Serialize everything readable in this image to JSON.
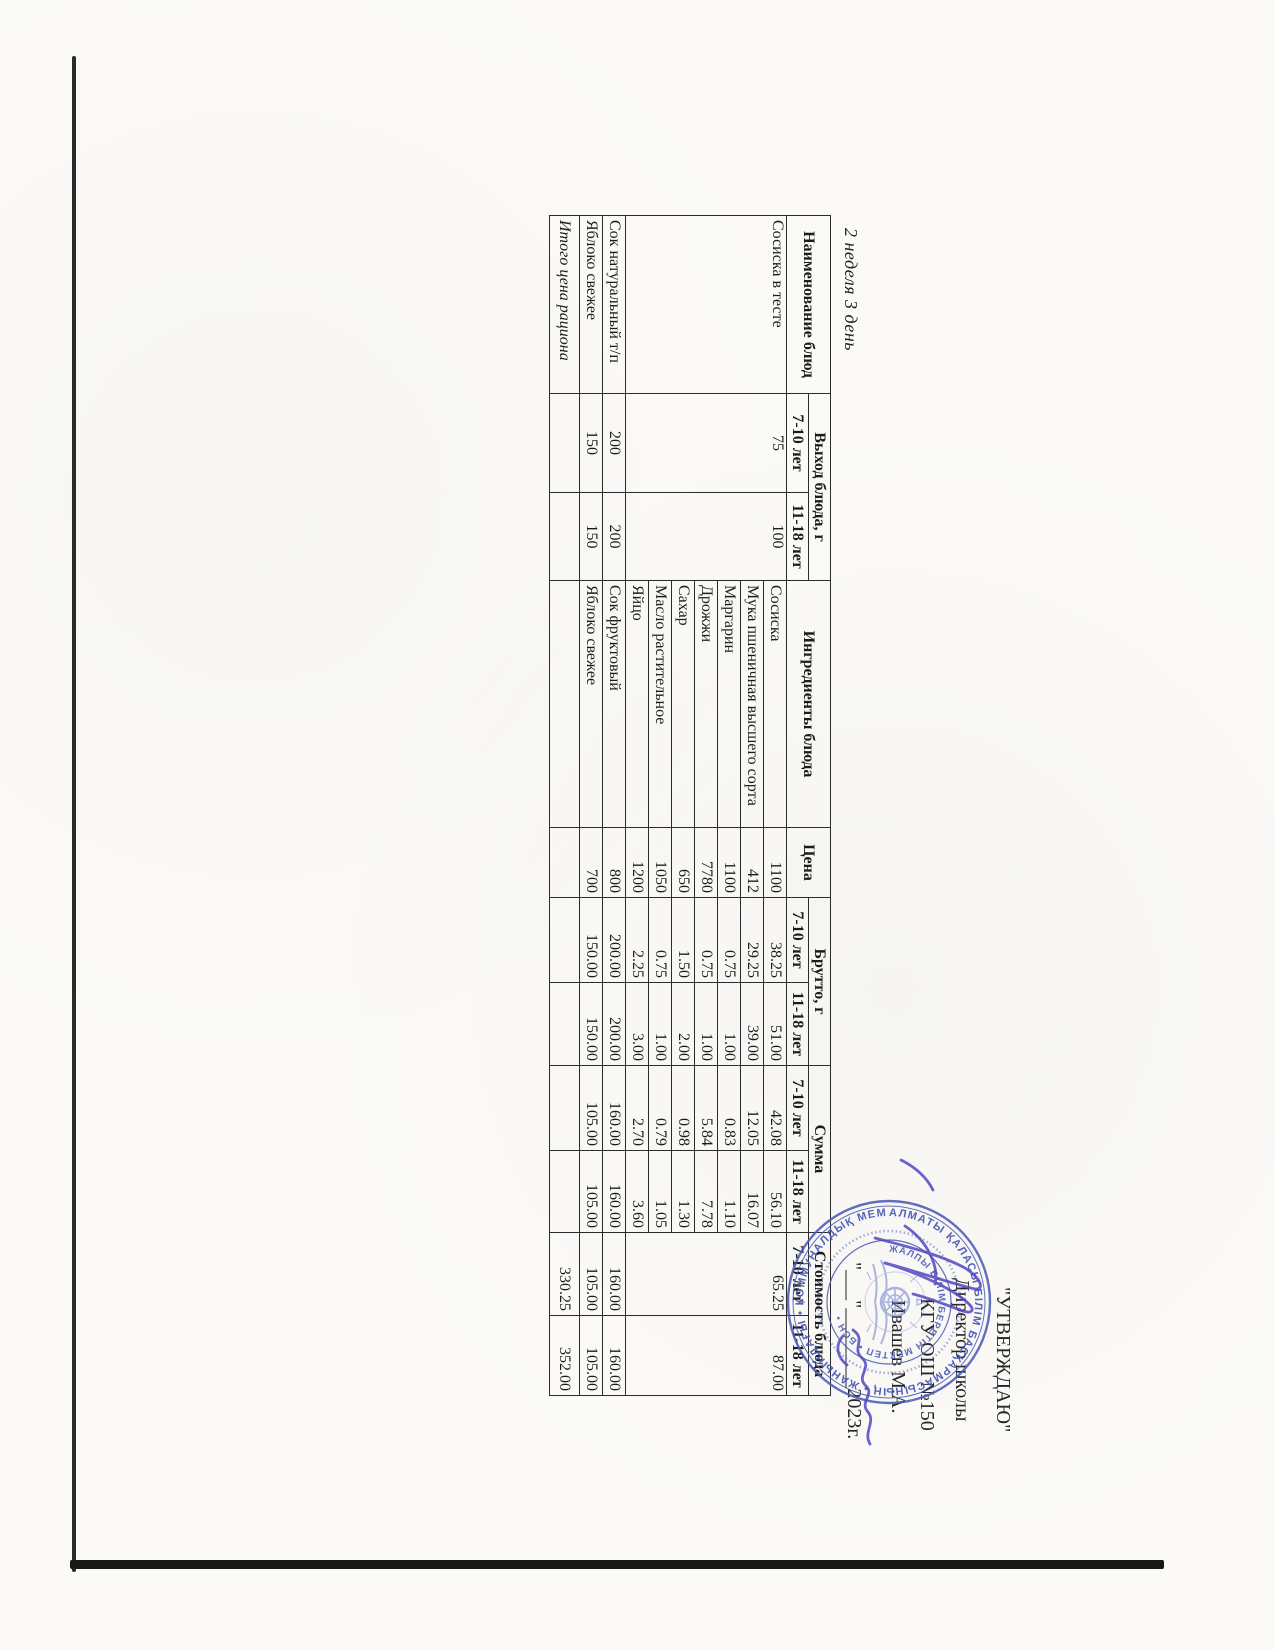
{
  "page": {
    "title": "2 неделя 3 день"
  },
  "approval": {
    "line1": "\"УТВЕРЖДАЮ\"",
    "line2": "Директор школы",
    "line3": "КГУ ОШ №150",
    "line4": "Ивашев М.А.",
    "line5": "\"___\"________2023г."
  },
  "stamp": {
    "ring_outer": "АЛМАТЫ ҚАЛАСЫ БІЛІМ БАСҚАРМАСЫНЫҢ • ЖАНЫНДАҒЫ • КОММУНАЛДЫҚ МЕМЛЕКЕТТІК МЕКЕМЕСІ",
    "ring_inner": "ЖАЛПЫ БІЛІМ БЕРЕТІН МЕКТЕП • БСН •",
    "star": "*",
    "ink_color": "#4656b6"
  },
  "table": {
    "col_widths": [
      178,
      99,
      88,
      247,
      70,
      85,
      83,
      85,
      82,
      83,
      80
    ],
    "header_row1": [
      {
        "t": "Наименование блюд",
        "rs": 2
      },
      {
        "t": "Выход блюда, г",
        "cs": 2
      },
      {
        "t": "Ингредиенты блюда",
        "rs": 2
      },
      {
        "t": "Цена",
        "rs": 2
      },
      {
        "t": "Брутто, г",
        "cs": 2
      },
      {
        "t": "Сумма",
        "cs": 2
      },
      {
        "t": "Стоимость блюда",
        "cs": 2
      }
    ],
    "header_row2": [
      "7-10 лет",
      "11-18 лет",
      "7-10 лет",
      "11-18 лет",
      "7-10 лет",
      "11-18 лет",
      "7-10 лет",
      "11-18 лет"
    ],
    "rows": [
      [
        {
          "t": "Сосиска в тесте",
          "rs": 7,
          "al": "l",
          "va": "t"
        },
        {
          "t": "75",
          "rs": 7,
          "al": "c",
          "va": "t"
        },
        {
          "t": "100",
          "rs": 7,
          "al": "c",
          "va": "t"
        },
        {
          "t": "Сосиска",
          "al": "l"
        },
        {
          "t": "1100",
          "al": "r"
        },
        {
          "t": "38.25",
          "al": "r"
        },
        {
          "t": "51.00",
          "al": "r"
        },
        {
          "t": "42.08",
          "al": "r"
        },
        {
          "t": "56.10",
          "al": "r"
        },
        {
          "t": "65.25",
          "rs": 7,
          "al": "r",
          "va": "t"
        },
        {
          "t": "87.00",
          "rs": 7,
          "al": "r",
          "va": "t"
        }
      ],
      [
        {
          "t": "Мука пшеничная высшего сорта",
          "al": "l"
        },
        {
          "t": "412",
          "al": "r"
        },
        {
          "t": "29.25",
          "al": "r"
        },
        {
          "t": "39.00",
          "al": "r"
        },
        {
          "t": "12.05",
          "al": "r"
        },
        {
          "t": "16.07",
          "al": "r"
        }
      ],
      [
        {
          "t": "Маргарин",
          "al": "l"
        },
        {
          "t": "1100",
          "al": "r"
        },
        {
          "t": "0.75",
          "al": "r"
        },
        {
          "t": "1.00",
          "al": "r"
        },
        {
          "t": "0.83",
          "al": "r"
        },
        {
          "t": "1.10",
          "al": "r"
        }
      ],
      [
        {
          "t": "Дрожжи",
          "al": "l"
        },
        {
          "t": "7780",
          "al": "r"
        },
        {
          "t": "0.75",
          "al": "r"
        },
        {
          "t": "1.00",
          "al": "r"
        },
        {
          "t": "5.84",
          "al": "r"
        },
        {
          "t": "7.78",
          "al": "r"
        }
      ],
      [
        {
          "t": "Сахар",
          "al": "l"
        },
        {
          "t": "650",
          "al": "r"
        },
        {
          "t": "1.50",
          "al": "r"
        },
        {
          "t": "2.00",
          "al": "r"
        },
        {
          "t": "0.98",
          "al": "r"
        },
        {
          "t": "1.30",
          "al": "r"
        }
      ],
      [
        {
          "t": "Масло растительное",
          "al": "l"
        },
        {
          "t": "1050",
          "al": "r"
        },
        {
          "t": "0.75",
          "al": "r"
        },
        {
          "t": "1.00",
          "al": "r"
        },
        {
          "t": "0.79",
          "al": "r"
        },
        {
          "t": "1.05",
          "al": "r"
        }
      ],
      [
        {
          "t": "Яйцо",
          "al": "l"
        },
        {
          "t": "1200",
          "al": "r"
        },
        {
          "t": "2.25",
          "al": "r"
        },
        {
          "t": "3.00",
          "al": "r"
        },
        {
          "t": "2.70",
          "al": "r"
        },
        {
          "t": "3.60",
          "al": "r"
        }
      ],
      [
        {
          "t": "Сок натуральный т/п",
          "al": "l"
        },
        {
          "t": "200",
          "al": "c"
        },
        {
          "t": "200",
          "al": "c"
        },
        {
          "t": "Сок фруктовый",
          "al": "l"
        },
        {
          "t": "800",
          "al": "r"
        },
        {
          "t": "200.00",
          "al": "r"
        },
        {
          "t": "200.00",
          "al": "r"
        },
        {
          "t": "160.00",
          "al": "r"
        },
        {
          "t": "160.00",
          "al": "r"
        },
        {
          "t": "160.00",
          "al": "r"
        },
        {
          "t": "160.00",
          "al": "r"
        }
      ],
      [
        {
          "t": "Яблоко свежее",
          "al": "l"
        },
        {
          "t": "150",
          "al": "c"
        },
        {
          "t": "150",
          "al": "c"
        },
        {
          "t": "Яблоко свежее",
          "al": "l"
        },
        {
          "t": "700",
          "al": "r"
        },
        {
          "t": "150.00",
          "al": "r"
        },
        {
          "t": "150.00",
          "al": "r"
        },
        {
          "t": "105.00",
          "al": "r"
        },
        {
          "t": "105.00",
          "al": "r"
        },
        {
          "t": "105.00",
          "al": "r"
        },
        {
          "t": "105.00",
          "al": "r"
        }
      ],
      [
        {
          "t": "Итого цена рациона",
          "al": "l",
          "cls": "total-label"
        },
        {
          "t": ""
        },
        {
          "t": ""
        },
        {
          "t": ""
        },
        {
          "t": ""
        },
        {
          "t": ""
        },
        {
          "t": ""
        },
        {
          "t": ""
        },
        {
          "t": ""
        },
        {
          "t": "330.25",
          "al": "r",
          "cls": "total-value"
        },
        {
          "t": "352.00",
          "al": "r",
          "cls": "total-value"
        }
      ]
    ]
  }
}
